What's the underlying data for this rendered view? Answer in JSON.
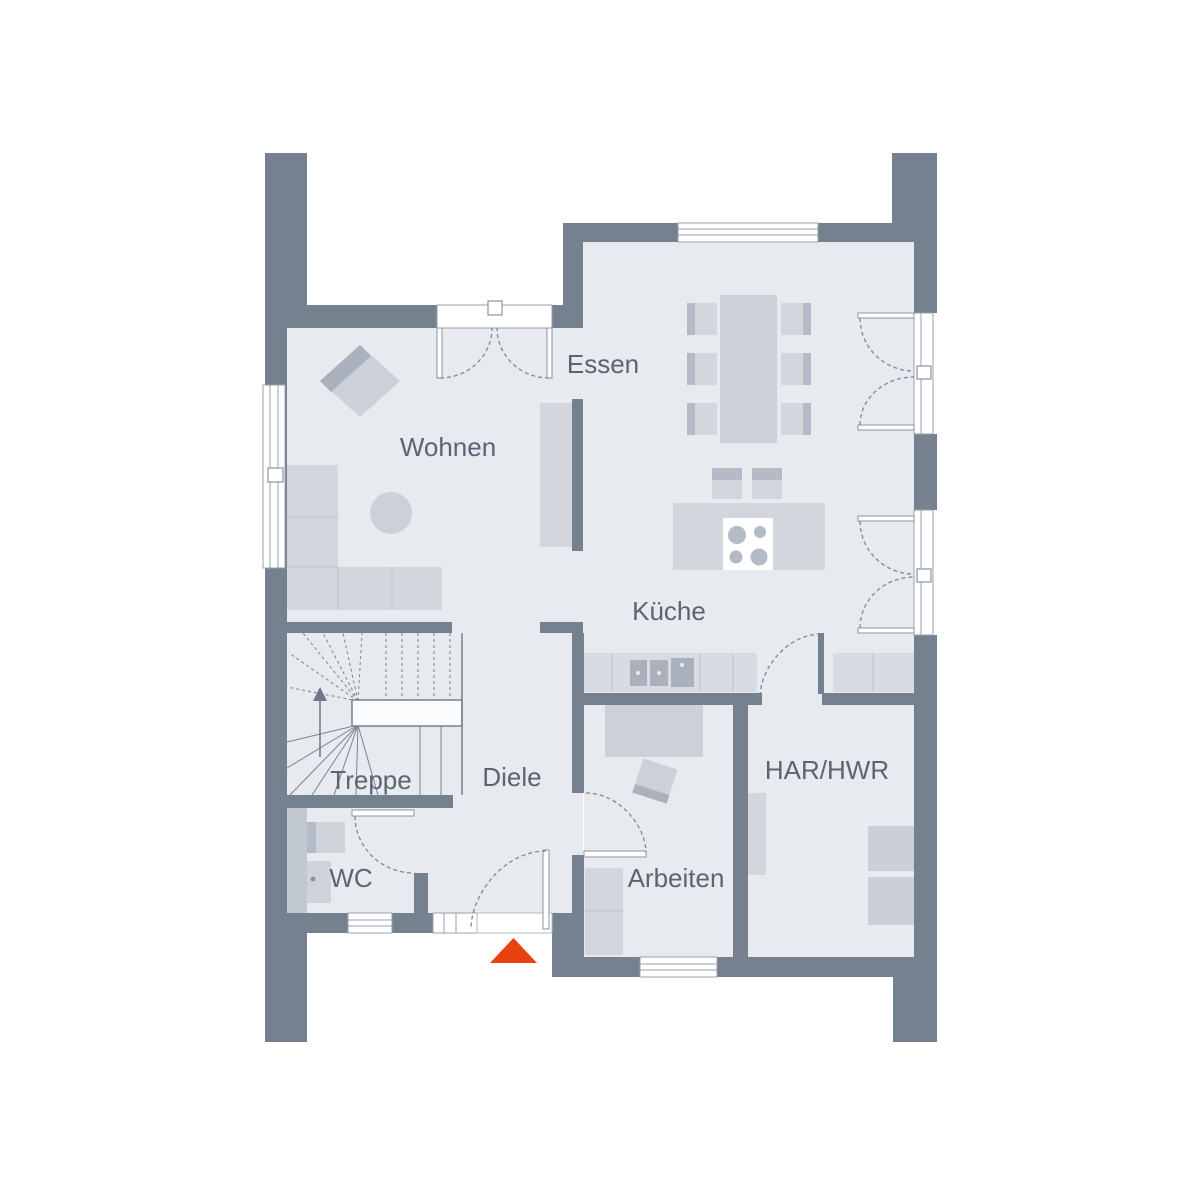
{
  "floorplan": {
    "rooms": [
      {
        "id": "wohnen",
        "label": "Wohnen"
      },
      {
        "id": "essen",
        "label": "Essen"
      },
      {
        "id": "kueche",
        "label": "Küche"
      },
      {
        "id": "treppe",
        "label": "Treppe"
      },
      {
        "id": "diele",
        "label": "Diele"
      },
      {
        "id": "wc",
        "label": "WC"
      },
      {
        "id": "arbeiten",
        "label": "Arbeiten"
      },
      {
        "id": "har-hwr",
        "label": "HAR/HWR"
      }
    ],
    "entrance": {
      "symbol": "triangle-up"
    },
    "colors": {
      "background": "#ffffff",
      "floor": "#e7eaef",
      "walls": "#76818f",
      "furniture": "#d3d6dd",
      "furniture_accent": "#b4bac6",
      "room_labels": "#5a6472",
      "entrance_marker": "#e8430f"
    }
  }
}
